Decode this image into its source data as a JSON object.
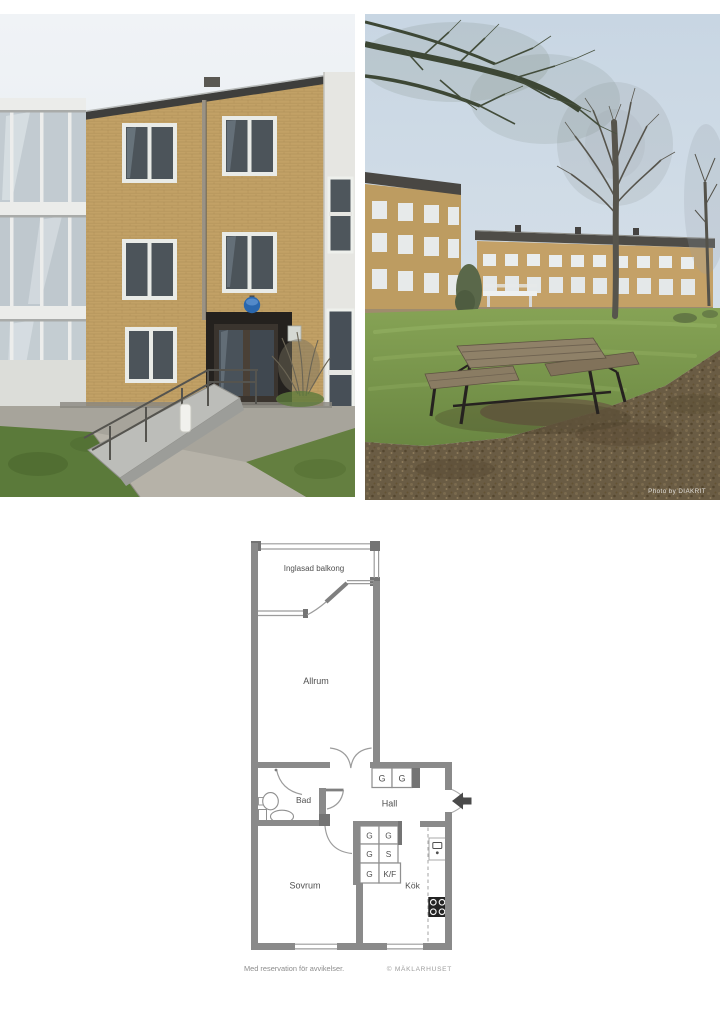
{
  "photos": {
    "right_watermark": "Photo by DIAKRIT"
  },
  "floorplan": {
    "labels": {
      "balcony": "Inglasad balkong",
      "living_room": "Allrum",
      "bathroom": "Bad",
      "hall": "Hall",
      "bedroom": "Sovrum",
      "kitchen": "Kök"
    },
    "closet_labels": {
      "wardrobe": "G",
      "pantry": "S",
      "fridge_freezer": "K/F"
    },
    "footer": {
      "disclaimer": "Med reservation för avvikelser.",
      "credit": "© MÄKLARHUSET"
    },
    "colors": {
      "wall": "#8a8a8a",
      "label_text": "#4f4f4f"
    }
  }
}
